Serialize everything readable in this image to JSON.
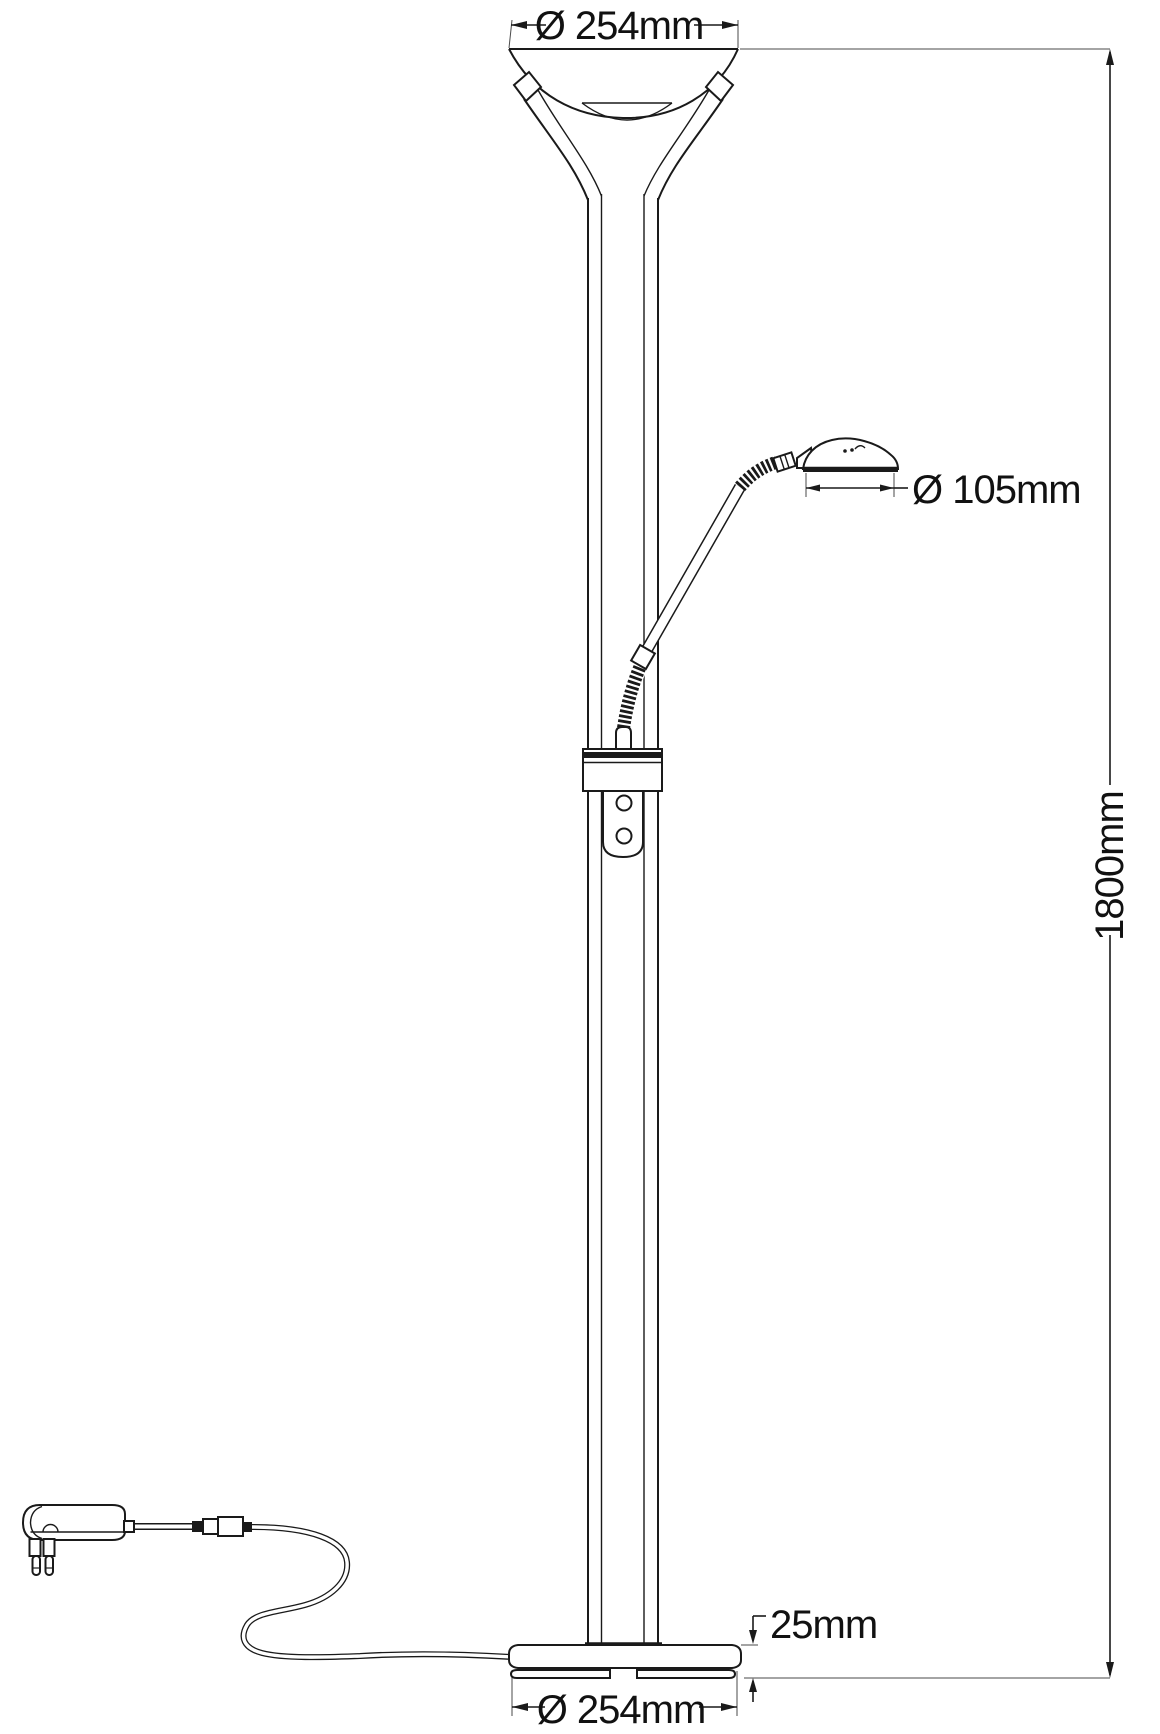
{
  "diagram": {
    "kind": "technical line drawing",
    "subject": "mother-and-child uplighter floor lamp with reading arm, power adapter and dimension callouts",
    "colors": {
      "line": "#1a1a1a",
      "background": "#ffffff"
    }
  },
  "labels": {
    "shade_diameter": "Ø 254mm",
    "head_diameter": "Ø 105mm",
    "height": "1800mm",
    "base_thickness": "25mm",
    "base_diameter": "Ø 254mm"
  }
}
